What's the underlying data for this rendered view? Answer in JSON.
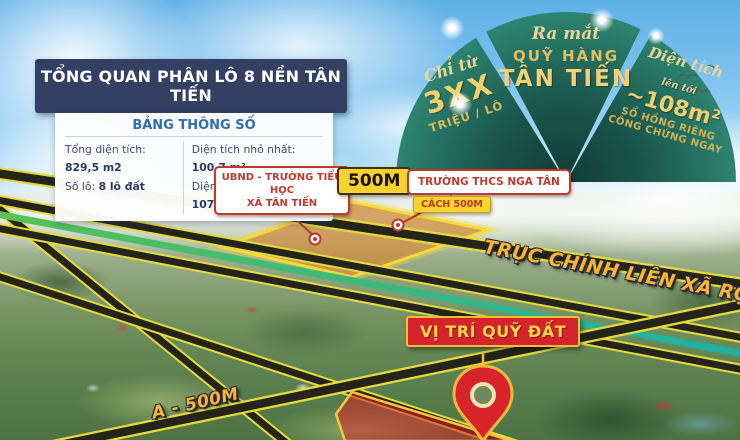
{
  "info_box": {
    "title": "TỔNG QUAN PHÂN LÔ 8 NỀN TÂN TIẾN",
    "table_title": "BẢNG THÔNG SỐ",
    "stats": {
      "total_area_label": "Tổng diện tích:",
      "total_area_value": "829,5 m2",
      "lot_count_label": "Số lô:",
      "lot_count_value": "8 lô đất",
      "min_area_label": "Diện tích nhỏ nhất:",
      "min_area_value": "100,7 m²",
      "max_area_label": "Diện tích lớn nhất:",
      "max_area_value": "107,9 m²"
    }
  },
  "promo_fan": {
    "left": {
      "script_text": "Chỉ từ",
      "big_text": "3XX",
      "sub_text": "TRIỆU / LÔ"
    },
    "center": {
      "script_text": "Ra mắt",
      "line1": "QUỸ HÀNG",
      "line2": "TÂN TIẾN"
    },
    "right": {
      "script_text": "Diện tích",
      "prefix": "lên tới",
      "big_text": "~108m²",
      "sub1": "SỔ HỒNG RIÊNG",
      "sub2": "CÔNG CHỨNG NGAY"
    }
  },
  "map_labels": {
    "school_primary_line1": "UBND - TRƯỜNG TIỂU HỌC",
    "school_primary_line2": "XÃ TÂN TIẾN",
    "distance_badge": "500M",
    "school_secondary": "TRƯỜNG THCS NGA TÂN",
    "distance_note": "CÁCH 500M",
    "main_road": "TRỤC CHÍNH LIÊN XÃ RỘNG 8M",
    "bottom_road": "A - 500M",
    "site_marker": "VỊ TRÍ QUỸ ĐẤT"
  },
  "colors": {
    "navy": "#333f63",
    "fan_teal": "#1c5b50",
    "gold": "#eccf72",
    "accent_yellow": "#f8d22e",
    "accent_red": "#d6232b",
    "road_casing": "#e6db3c"
  }
}
